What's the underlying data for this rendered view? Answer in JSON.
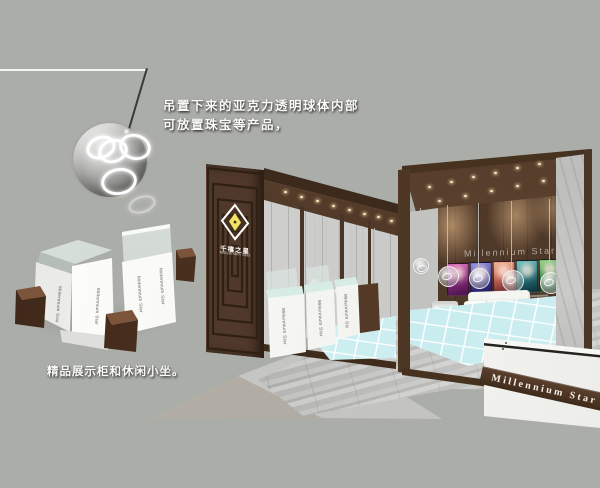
{
  "annotations": {
    "sphere_note_line1": "吊置下来的亚克力透明球体内部",
    "sphere_note_line2": "可放置珠宝等产品，",
    "display_note": "精品展示柜和休闲小坐。"
  },
  "brand": {
    "logo_cn": "千禧之星",
    "logo_en": "Millennium Star",
    "back_wall_sign": "Millennium Star",
    "reception_sign": "Millennium Star",
    "counter_label": "Millennium Star"
  },
  "colors": {
    "background": "#abada8",
    "booth_wood_dark": "#3f2c1d",
    "booth_wood_mid": "#553c2a",
    "maze_wall": "#50392a",
    "glass_floor_cyan": "#cdeef0",
    "counter_white": "#f6f6f2",
    "stool_brown": "#5a3b28",
    "logo_yellow": "#f0e362",
    "poster_colors": [
      "#a8308c",
      "#4a3a9c",
      "#c8684e",
      "#2a7d85",
      "#3f8f4a"
    ]
  }
}
